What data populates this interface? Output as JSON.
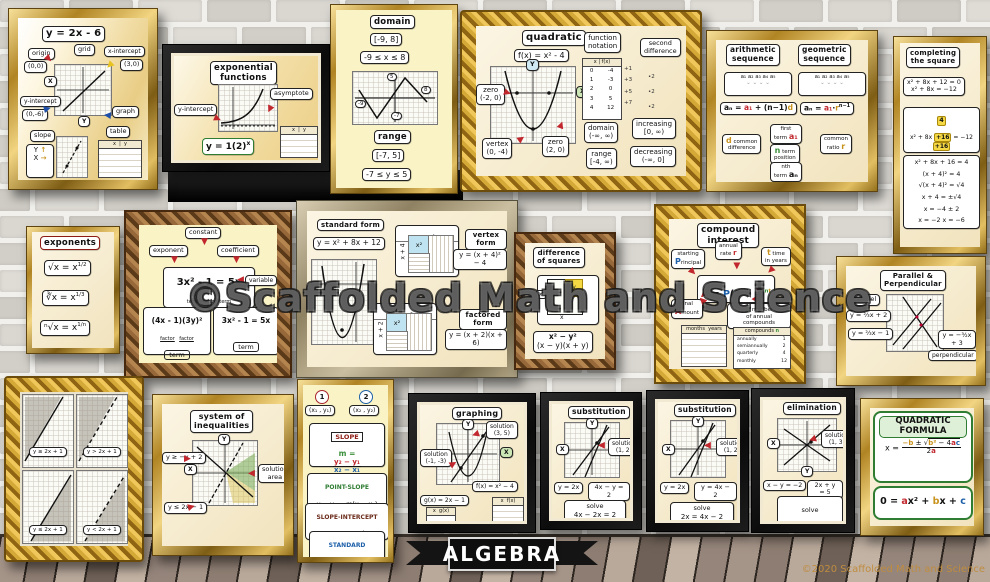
{
  "icons": {
    "arrow": "▶",
    "arrow_down": "▼",
    "arrow_left": "◀",
    "caret": "⌄ ⌄ ⌄ ⌄",
    "up": "↑",
    "right": "→"
  },
  "watermark": "©Scaffolded Math and Science",
  "banner": "ALGEBRA",
  "copyright": "©2020 Scaffolded Math and Science",
  "posters": {
    "linear": {
      "title": "y = 2x - 6",
      "origin": "origin",
      "origin_pt": "(0,0)",
      "grid": "grid",
      "x_int": "x-intercept",
      "x_int_pt": "(3,0)",
      "y_int": "y-intercept",
      "y_int_pt": "(0,-6)",
      "graph": "graph",
      "x": "X",
      "y": "Y",
      "slope": "slope",
      "table": "table",
      "tbl_x": "x",
      "tbl_y": "y"
    },
    "exponential": {
      "title": "exponential\nfunctions",
      "y_int": "y-intercept",
      "asymptote": "asymptote",
      "eq_base": "y = 1(2)",
      "eq_exp": "x",
      "tx": "x",
      "ty": "y"
    },
    "domain_range": {
      "domain": "domain",
      "d_int": "[-9, 8]",
      "d_ineq": "-9 ≤ x ≤ 8",
      "range": "range",
      "r_int": "[-7, 5]",
      "r_ineq": "-7 ≤ y ≤ 5",
      "t_top": "5",
      "t_right": "8",
      "t_left": "-9",
      "t_bottom": "-7"
    },
    "quadratic": {
      "title": "quadratic",
      "equation": "f(x) = x² - 4",
      "y": "Y",
      "x": "X",
      "zero": "zero",
      "zero1_pt": "(-2, 0)",
      "zero2_pt": "(2, 0)",
      "vertex": "vertex",
      "vertex_pt": "(0, -4)",
      "fn": "function\nnotation",
      "col_x": "x",
      "col_fx": "f(x)",
      "x_vals": "0\n1\n2\n3\n4",
      "fx_vals": "-4\n-3\n0\n5\n12",
      "diffs": "+1\n+3\n+5\n+7",
      "second": "second\ndifference",
      "second_vals": "•2\n•2\n•2",
      "domain": "domain",
      "domain_val": "(-∞, ∞)",
      "increasing": "increasing",
      "increasing_val": "[0, ∞)",
      "range": "range",
      "range_val": "[-4, ∞)",
      "decreasing": "decreasing",
      "decreasing_val": "(-∞, 0]"
    },
    "sequences": {
      "arith_title": "arithmetic\nsequence",
      "geo_title": "geometric\nsequence",
      "terms": "a₁  a₂  a₃  a₄  a₅",
      "arith_f1": "aₙ = ",
      "arith_a1": "a₁",
      "arith_f2": " + (n−1)",
      "arith_d": "d",
      "geo_f1": "aₙ = ",
      "geo_a1": "a₁",
      "geo_dot": "·",
      "geo_r": "r",
      "geo_exp": "n−1",
      "common_diff": "common\ndifference",
      "cd_sym": "d",
      "first_term": "first\nterm",
      "ft_sym": "a₁",
      "term_pos": "term\nposition",
      "tp_sym": "n",
      "common_ratio": "common\nratio",
      "cr_sym": "r",
      "nth_term": "nth\nterm",
      "nt_sym": "aₙ"
    },
    "completing": {
      "title": "completing\nthe square",
      "line1": "x² + 8x + 12 = 0",
      "line2": "x² + 8x = −12",
      "half": "4",
      "diag1": "x² + 8x ",
      "diag_chip": "+16",
      "diag2": " = −12 ",
      "steps": "x² + 8x + 16 = 4\n(x + 4)² = 4\n√(x + 4)² = √4\nx + 4 = ±√4\nx = −4 ± 2\nx = −2   x = −6"
    },
    "exponents": {
      "title": "exponents",
      "l1b": "√x = x",
      "l1e": "1/2",
      "l2b": "∛x = x",
      "l2e": "1/3",
      "l3b": "ⁿ√x = x",
      "l3e": "1/n"
    },
    "expression": {
      "constant": "constant",
      "exponent": "exponent",
      "coefficient": "coefficient",
      "variable": "variable",
      "equation": "3x² - 1 = 5x",
      "term": "term",
      "factor": "factor",
      "expr2": "(4x - 1)(3y)²"
    },
    "forms": {
      "standard_l": "standard form",
      "standard_eq": "y = x² + 8x + 12",
      "vertex_l": "vertex form",
      "vertex_eq": "y = (x + 4)² − 4",
      "factored_l": "factored form",
      "factored_eq": "y = (x + 2)(x + 6)",
      "m1_top": "x + 4",
      "m1_side": "x + 4",
      "m2_top": "x + 6",
      "m2_side": "x + 2",
      "cell": "x²"
    },
    "diff_squares": {
      "title": "difference\nof squares",
      "x": "x",
      "y": "y",
      "num": "x² − y²",
      "den": "(x − y)(x + y)"
    },
    "compound": {
      "title": "compound\ninterest",
      "fA": "A",
      "feq": " = ",
      "fP": "P",
      "fopen": "(1 + ",
      "fr": "r",
      "fn": "n",
      "fclose": ")",
      "fexp_n": "n",
      "fexp_t": "t",
      "starting": "starting",
      "principal_head": "P",
      "principal_rest": "rincipal",
      "annual": "annual\nrate",
      "ar_sym": "r",
      "time_l": "time",
      "t_sym": "t",
      "time_sub": "in years",
      "final_l": "final",
      "a_head": "A",
      "a_rest": "mount",
      "number_l": "number",
      "n_sym": "n",
      "number_sub": "of annual compounds",
      "months_hdr": "months  years",
      "comp_hdr": "compounds",
      "comp_n": "n",
      "comp_names": "annually\nsemiannually\nquarterly\nmonthly",
      "comp_vals": "1\n2\n4\n12"
    },
    "parallel": {
      "title": "Parallel &\nPerpendicular",
      "parallel": "parallel",
      "eq1": "y = ⅔x + 2",
      "eq2": "y = ⅔x − 1",
      "eq3": "y = −³⁄₂x + 3",
      "perpendicular": "perpendicular"
    },
    "panes": {
      "p1": "y ≥ 2x + 1",
      "p2": "y > 2x + 1",
      "p3": "y ≤ 2x + 1",
      "p4": "y < 2x + 1"
    },
    "system": {
      "title": "system of\ninequalities",
      "y": "Y",
      "x": "X",
      "ineq1": "y ≥ −x + 2",
      "ineq2": "y ≤ 2x − 1",
      "solution": "solution\narea"
    },
    "line_forms": {
      "n1": "1",
      "p1": "(x₁ , y₁)",
      "n2": "2",
      "p2": "(x₂ , y₂)",
      "slope_t": "SLOPE",
      "m": "m =",
      "num": "y₂ − y₁",
      "den": "x₂ − x₁",
      "ps_t": "POINT-SLOPE",
      "ps": "y − y₁ = m(x − x₁)",
      "si_t": "SLOPE-INTERCEPT",
      "si": "y = mx + b",
      "st_t": "STANDARD",
      "st": "ax + by = c"
    },
    "graphing": {
      "title": "graphing",
      "y": "Y",
      "x": "X",
      "sol1": "solution\n(3, 5)",
      "sol2": "solution\n(-1, -3)",
      "f_eq": "f(x) = x² − 4",
      "g_eq": "g(x) = 2x − 1",
      "tf": "x  f(x)",
      "tg": "x  g(x)"
    },
    "sub1": {
      "title": "substitution",
      "y": "Y",
      "x": "X",
      "sol": "solution\n(1, 2)",
      "eq1": "y = 2x",
      "eq2": "4x − y = 2",
      "solve": "solve",
      "solve_eq": "4x − 2x = 2"
    },
    "sub2": {
      "title": "substitution",
      "y": "Y",
      "x": "X",
      "sol": "solution\n(1, 2)",
      "eq1": "y = 2x",
      "eq2": "y = 4x − 2",
      "solve": "solve",
      "solve_eq": "2x = 4x − 2"
    },
    "elim": {
      "title": "elimination",
      "y": "Y",
      "x": "X",
      "sol": "solution\n(1, 3)",
      "eq1": "x − y = −2",
      "eq2": "2x + y = 5",
      "solve": "solve",
      "plus": "+",
      "solve_l1": "x − y = −2",
      "solve_l2": "2x + y = 5"
    },
    "quad_formula": {
      "title": "QUADRATIC\nFORMULA",
      "x_eq": "x = ",
      "nb": "−b",
      "pm": " ± ",
      "rad": "√",
      "rb": "b²",
      "rm": " − 4",
      "ra": "a",
      "rc": "c",
      "den2": "2",
      "den_a": "a",
      "z0": "0 = ",
      "za": "a",
      "zx2": "x²",
      "zp1": " + ",
      "zb": "b",
      "zx": "x",
      "zp2": " + ",
      "zc": "c"
    }
  }
}
